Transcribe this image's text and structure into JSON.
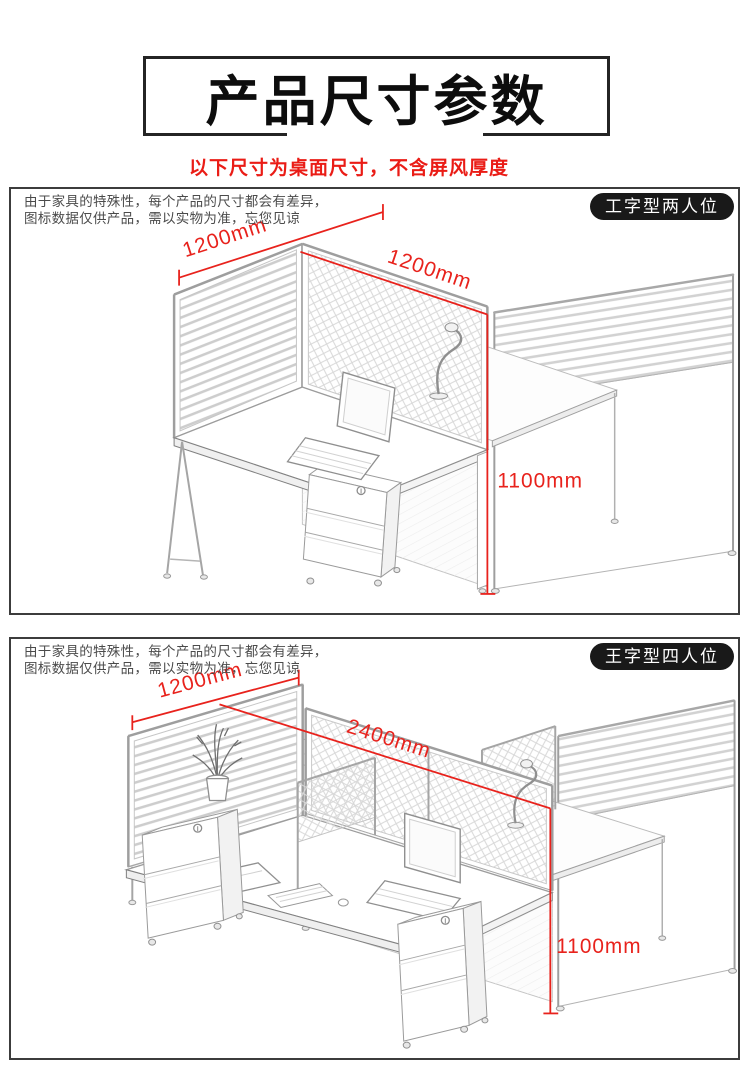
{
  "header": {
    "title": "产品尺寸参数",
    "subtitle": "以下尺寸为桌面尺寸，不含屏风厚度"
  },
  "colors": {
    "accent_red": "#e8221c",
    "sketch_gray": "#b9b9b9",
    "panel_border": "#3c3c3c",
    "badge_bg": "#191919",
    "badge_text": "#ffffff"
  },
  "panels": [
    {
      "badge": "工字型两人位",
      "disclaimer": [
        "由于家具的特殊性，每个产品的尺寸都会有差异，",
        "图标数据仅供产品，需以实物为准，忘您见谅"
      ],
      "dims": {
        "width": "1200mm",
        "depth": "1200mm",
        "height": "1100mm"
      }
    },
    {
      "badge": "王字型四人位",
      "disclaimer": [
        "由于家具的特殊性，每个产品的尺寸都会有差异，",
        "图标数据仅供产品，需以实物为准，忘您见谅"
      ],
      "dims": {
        "width": "1200mm",
        "length": "2400mm",
        "height": "1100mm"
      }
    }
  ]
}
